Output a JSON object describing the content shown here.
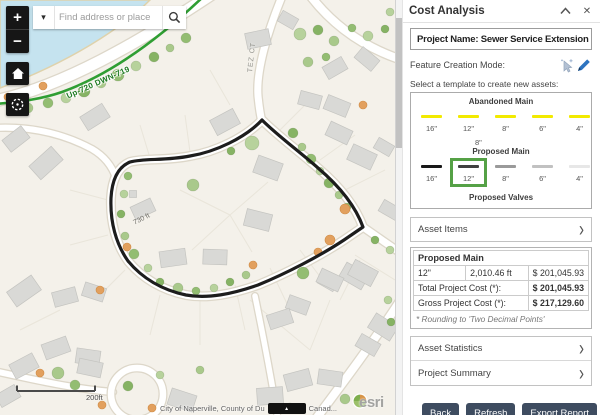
{
  "panel": {
    "title": "Cost Analysis",
    "close_glyph": "✕",
    "project_name": "Project Name: Sewer Service Extension",
    "feature_creation_label": "Feature Creation Mode:",
    "template_prompt": "Select a template to create new assets:",
    "templates": {
      "abandoned": {
        "title": "Abandoned Main",
        "color": "#f2ea00",
        "items": [
          "16\"",
          "12\"",
          "8\"",
          "6\"",
          "4\""
        ],
        "orphan_label": "8\""
      },
      "proposed": {
        "title": "Proposed Main",
        "colors": [
          "#181818",
          "#404040",
          "#9a9a9a",
          "#c1c1c1",
          "#e7e7e7"
        ],
        "items": [
          "16\"",
          "12\"",
          "8\"",
          "6\"",
          "4\""
        ],
        "selected_index": 1,
        "selection_color": "#55a146"
      },
      "valves": {
        "title": "Proposed Valves"
      }
    },
    "asset_items_label": "Asset Items",
    "results": {
      "header": "Proposed Main",
      "row": [
        "12\"",
        "2,010.46 ft",
        "$ 201,045.93"
      ],
      "total_label": "Total Project Cost (*):",
      "total_value": "$ 201,045.93",
      "gross_label": "Gross Project Cost (*):",
      "gross_value": "$ 217,129.60",
      "footnote": "* Rounding to 'Two Decimal Points'"
    },
    "asset_statistics_label": "Asset Statistics",
    "project_summary_label": "Project Summary",
    "buttons": {
      "back": "Back",
      "refresh": "Refresh",
      "export_report": "Export Report"
    }
  },
  "map": {
    "search": {
      "placeholder": "Find address or place"
    },
    "controls": {
      "zoom_in": "+",
      "zoom_out": "−"
    },
    "labels": {
      "pipe_label": "Up-720 DWN-719",
      "street_label": "TEZ CT",
      "measurement_label": "730 ft",
      "scalebar_label": "200ft"
    },
    "attribution": {
      "left": "City of Naperville, County of Du",
      "right": "Canad...",
      "esri": "esri"
    }
  }
}
